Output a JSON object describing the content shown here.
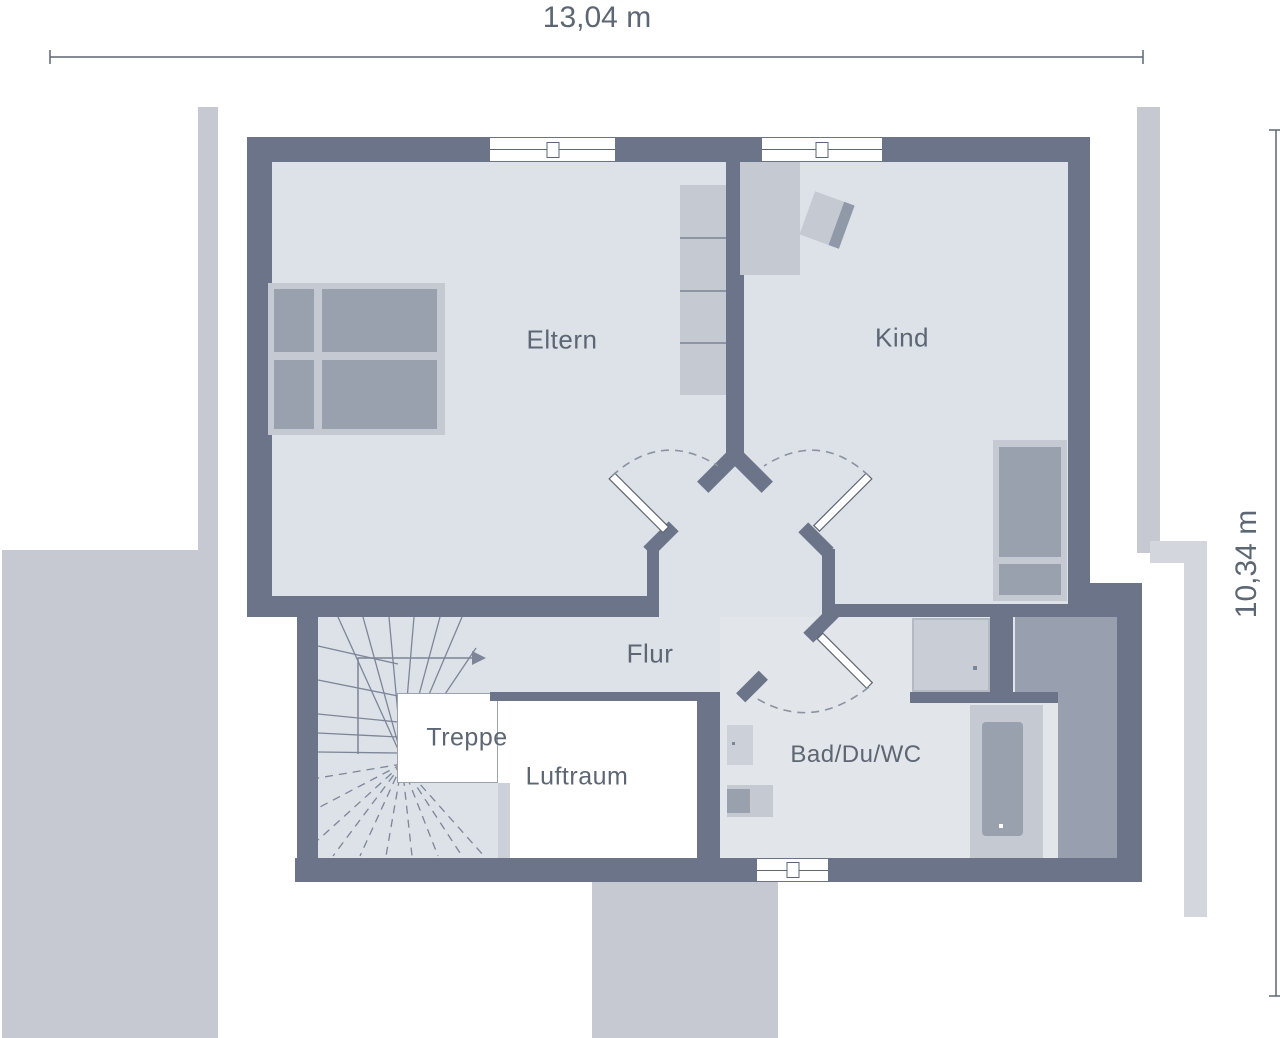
{
  "dimensions": {
    "width": "13,04 m",
    "height": "10,34 m"
  },
  "rooms": [
    {
      "label": "Eltern"
    },
    {
      "label": "Kind"
    },
    {
      "label": "Flur"
    },
    {
      "label": "Treppe"
    },
    {
      "label": "Luftraum"
    },
    {
      "label": "Bad/Du/WC"
    }
  ],
  "palette": {
    "wall": "#6B7488",
    "floor": "#DDE1E8",
    "floor-bad": "#E2E5EA",
    "pave": "#C6C9D1",
    "pave-light": "#D3D6DC",
    "furn-light": "#C5C9D1",
    "furn-dark": "#99A1AE",
    "block": "#98A0AF",
    "ink": "#5D6673",
    "stair": "#7D8698"
  }
}
